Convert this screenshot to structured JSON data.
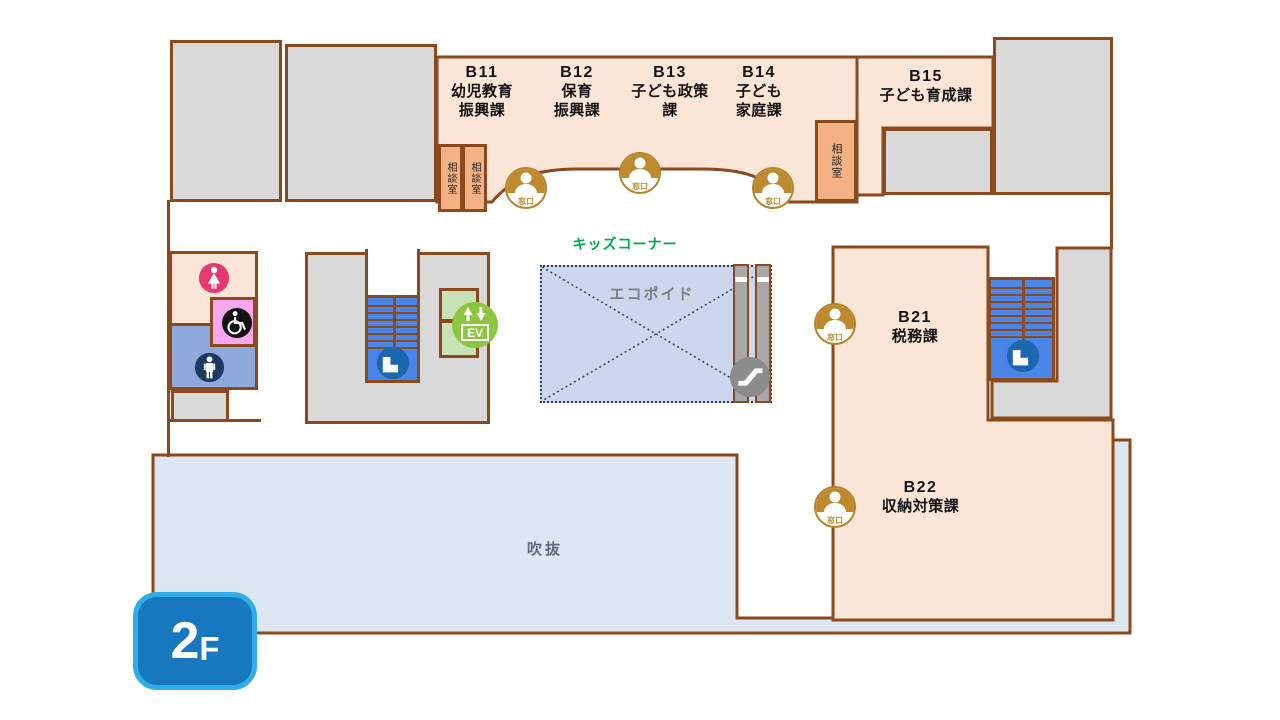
{
  "floor_badge": {
    "number": "2",
    "suffix": "F"
  },
  "departments": [
    {
      "code": "B11",
      "name_lines": [
        "幼児教育",
        "振興課"
      ]
    },
    {
      "code": "B12",
      "name_lines": [
        "保育",
        "振興課"
      ]
    },
    {
      "code": "B13",
      "name_lines": [
        "子ども政策",
        "課"
      ]
    },
    {
      "code": "B14",
      "name_lines": [
        "子ども",
        "家庭課"
      ]
    },
    {
      "code": "B15",
      "name_lines": [
        "子ども育成課"
      ]
    },
    {
      "code": "B21",
      "name_lines": [
        "税務課"
      ]
    },
    {
      "code": "B22",
      "name_lines": [
        "収納対策課"
      ]
    }
  ],
  "labels": {
    "consult_room": "相談室",
    "service_window": "窓口",
    "kids_corner": "キッズコーナー",
    "eco_void": "エコポイド",
    "atrium": "吹抜",
    "elevator": "EV"
  },
  "icons": {
    "service_window": "person-bust-icon",
    "stairs": "stairs-icon",
    "elevator": "ev-up-down-arrows-icon",
    "escalator": "escalator-icon",
    "womens_toilet": "female-icon",
    "accessible_toilet": "wheelchair-icon",
    "mens_toilet": "male-icon"
  },
  "colors": {
    "wall": "#8a4a1e",
    "room_peach": "#fbe5d6",
    "consult_orange": "#f4b183",
    "gray_room": "#d9d9d9",
    "stairs_blue": "#4a86e8",
    "stairs_icon_blue": "#1b66ae",
    "ev_green": "#8dc63f",
    "ev_room_green": "#c9e2b5",
    "window_gold": "#bf8a2e",
    "kids_green": "#00a850",
    "eco_fill": "#ccd7ee",
    "eco_border": "#2e3d66",
    "atrium_fill": "#dce7f2",
    "women_pink": "#e8396f",
    "accessible_room_pink": "#f8a6ee",
    "accessible_black": "#141414",
    "men_room_blue": "#8ea9db",
    "men_navy": "#1f3864",
    "escalator_gray": "#8c8c8c",
    "badge_blue": "#1878bf",
    "badge_border": "#2fade6"
  }
}
